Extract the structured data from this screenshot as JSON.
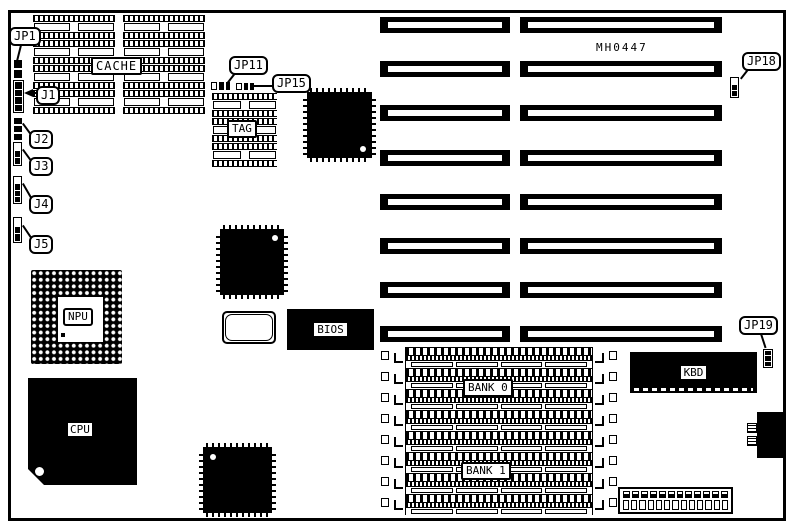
{
  "diagram": {
    "part_number": "MH0447",
    "chip_labels": {
      "cache": "CACHE",
      "tag": "TAG",
      "npu": "NPU",
      "cpu": "CPU",
      "bios": "BIOS",
      "kbd": "KBD",
      "bank0": "BANK 0",
      "bank1": "BANK 1"
    },
    "jumper_labels": {
      "jp1": "JP1",
      "j1": "J1",
      "j2": "J2",
      "j3": "J3",
      "j4": "J4",
      "j5": "J5",
      "jp11": "JP11",
      "jp15": "JP15",
      "jp18": "JP18",
      "jp19": "JP19"
    },
    "colors": {
      "ink": "#000000",
      "paper": "#ffffff"
    }
  }
}
